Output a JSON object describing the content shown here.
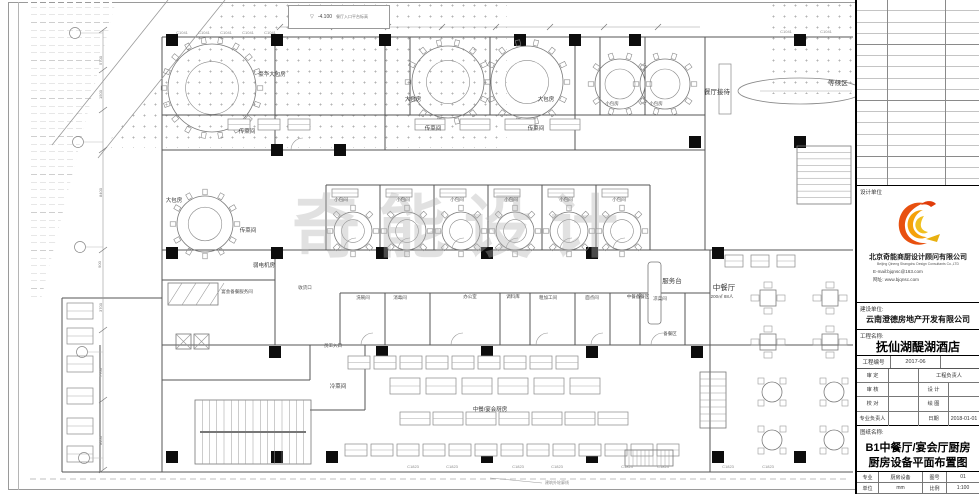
{
  "title_block": {
    "design_unit_label": "设计单位",
    "design_company_cn": "北京奇能商厨设计顾问有限公司",
    "design_company_en": "Beijing Qineng Shangchu Design Consultants Co.,LTD",
    "email": "E-mail:bjqnsc@163.com",
    "website": "网址: www.bjqnsc.com",
    "client_label": "建设单位:",
    "client_name": "云南澄德房地产开发有限公司",
    "project_label": "工程名称:",
    "project_name": "抚仙湖醍湖酒店",
    "project_no_label": "工程编号",
    "project_no": "2017-06",
    "approve_label": "审 定",
    "pm_label": "工程负责人",
    "check_label": "审 核",
    "design_label": "设 计",
    "proof_label": "校 对",
    "draw_label": "绘 图",
    "discipline_lead_label": "专业负责人",
    "date_label": "日期",
    "date_value": "2018-01-01",
    "sheet_name_label": "图纸名称:",
    "sheet_title_line1": "B1中餐厅/宴会厅厨房",
    "sheet_title_line2": "厨房设备平面布置图",
    "major_label": "专业",
    "major_value": "厨房设备",
    "sheet_no_label": "图号",
    "sheet_no_value": "01",
    "unit_label": "单位",
    "unit_value": "mm",
    "scale_label": "比例",
    "scale_value": "1:100"
  },
  "plan": {
    "watermark": "奇能设计",
    "elevation": {
      "value": "-4.100",
      "label": "餐厅入口平台标高"
    },
    "boundary_note": "建筑外轮廓线",
    "codes": {
      "top": "C1041",
      "bottom": "C1823"
    },
    "dimensions": [
      "5700",
      "1500",
      "8400",
      "900",
      "3700",
      "7700",
      "8400"
    ],
    "labels": [
      "豪华大包房",
      "大包房",
      "大包房",
      "小包房",
      "小包房",
      "餐厅接待",
      "等候区",
      "传菜间",
      "传菜间",
      "传菜间",
      "大包房",
      "传菜间",
      "小包间",
      "小包间",
      "小包间",
      "小包间",
      "小包间",
      "小包间",
      "弱电机房",
      "宴会备餐服务间",
      "服务台",
      "中餐厅",
      "200㎡ 88人",
      "中餐备餐区",
      "备餐区",
      "洗碗间",
      "消毒间",
      "办公室",
      "调料库",
      "粗加工间",
      "面点间",
      "凉菜间",
      "冷菜间",
      "中餐/宴会厨房",
      "员工入口",
      "收货口"
    ]
  }
}
